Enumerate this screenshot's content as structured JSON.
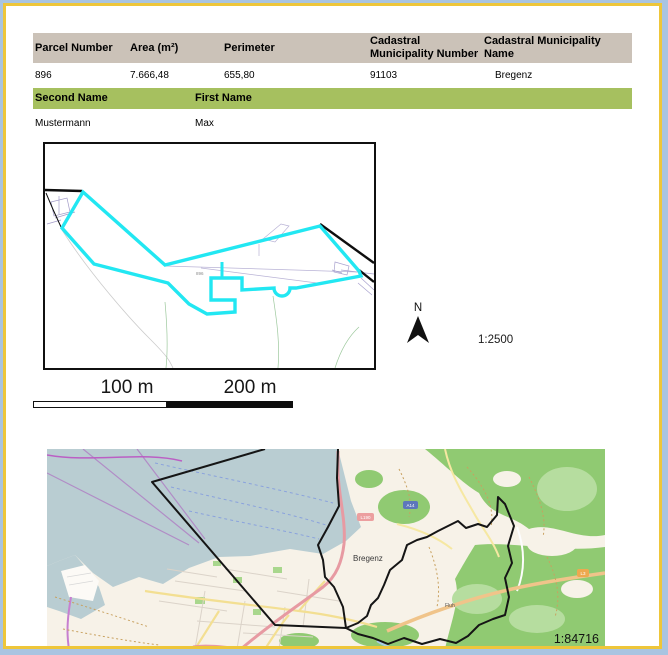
{
  "page": {
    "type_label": "Cadastral parcel report",
    "border_outer_color": "#a9c4e1",
    "border_inner_color": "#eec63a"
  },
  "parcel_table": {
    "header_bg": "#cbc2b8",
    "headers": [
      "Parcel Number",
      "Area (m²)",
      "Perimeter",
      "Cadastral Municipality Number",
      "Cadastral Municipality Name"
    ],
    "row": [
      "896",
      "7.666,48",
      "655,80",
      "91103",
      "Bregenz"
    ]
  },
  "owner_table": {
    "header_bg": "#a6c05f",
    "headers": [
      "Second Name",
      "First Name"
    ],
    "row": [
      "Mustermann",
      "Max"
    ]
  },
  "detail_map": {
    "highlight_color": "#22e7f2",
    "parcel_number_label": "896",
    "north_label": "N",
    "scale_label": "1:2500"
  },
  "scale_bar": {
    "labels": [
      "100 m",
      "200 m"
    ]
  },
  "overview_map": {
    "lake_color": "#b9cdd2",
    "forest_color": "#90ca72",
    "boundary_color": "#151515",
    "city_label": "Bregenz",
    "place_label": "Fluh",
    "road_shields": [
      "L190",
      "A14",
      "L3"
    ],
    "scale_label": "1:84716"
  }
}
